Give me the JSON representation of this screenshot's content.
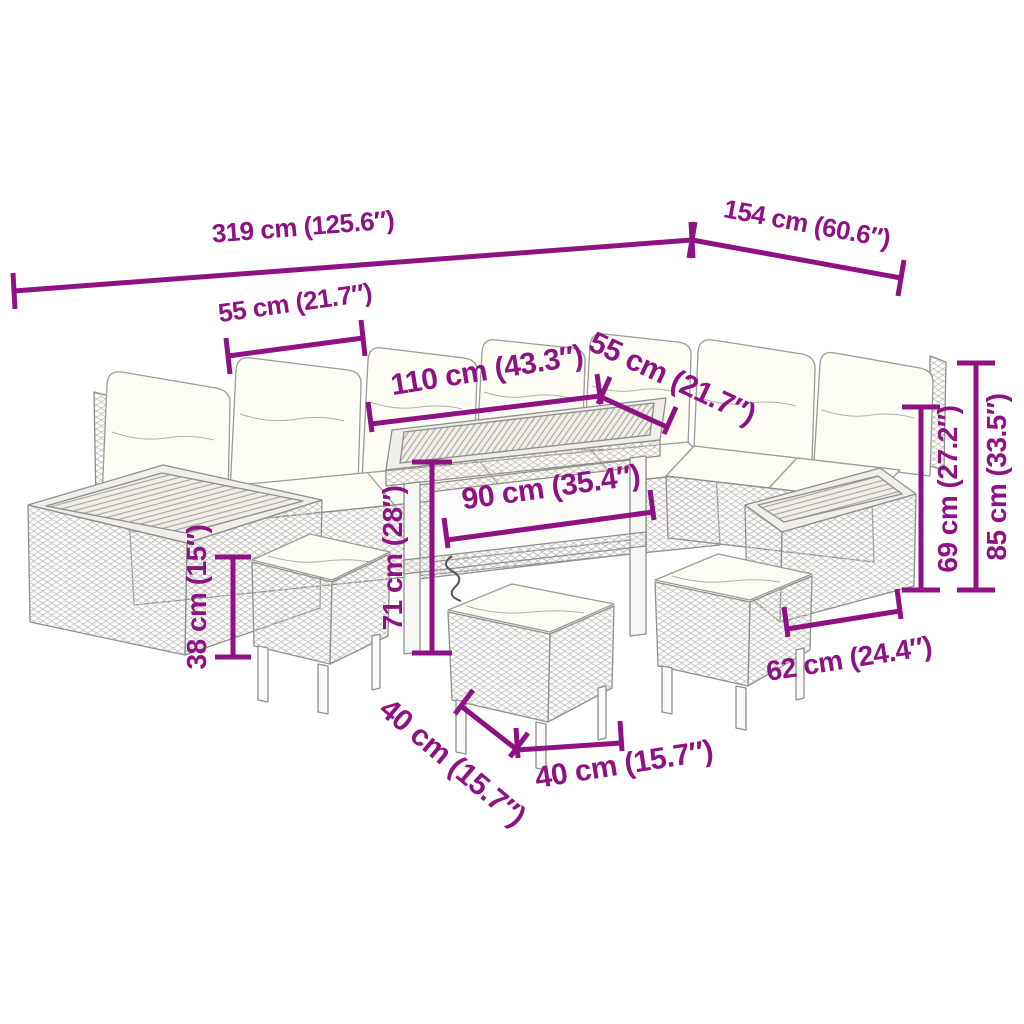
{
  "colors": {
    "accent": "#8E1283",
    "furniture_line": "#8f8f8f",
    "cushion_fill": "#fdfcf5"
  },
  "figure": {
    "type": "product-dimension-diagram",
    "subject": "poly rattan garden lounge set: corner sofa with cushions, wooden-top side tables, dining table and three stools"
  },
  "dims": {
    "overall_length": {
      "cm": "319",
      "inch": "125.6",
      "label": "319 cm (125.6″)"
    },
    "overall_depth": {
      "cm": "154",
      "inch": "60.6",
      "label": "154 cm (60.6″)"
    },
    "seat_width_left": {
      "cm": "55",
      "inch": "21.7",
      "label": "55 cm (21.7″)"
    },
    "sofa_section_length": {
      "cm": "110",
      "inch": "43.3",
      "label": "110 cm (43.3″)"
    },
    "seat_width_right": {
      "cm": "55",
      "inch": "21.7",
      "label": "55 cm (21.7″)"
    },
    "table_length": {
      "cm": "90",
      "inch": "35.4",
      "label": "90 cm (35.4″)"
    },
    "table_height": {
      "cm": "71",
      "inch": "28",
      "label": "71 cm (28″)"
    },
    "seat_height": {
      "cm": "38",
      "inch": "15",
      "label": "38 cm (15″)"
    },
    "backrest_height": {
      "cm": "69",
      "inch": "27.2",
      "label": "69 cm (27.2″)"
    },
    "total_height": {
      "cm": "85",
      "inch": "33.5",
      "label": "85 cm (33.5″)"
    },
    "side_table_length": {
      "cm": "62",
      "inch": "24.4",
      "label": "62 cm (24.4″)"
    },
    "stool_depth": {
      "cm": "40",
      "inch": "15.7",
      "label": "40 cm (15.7″)"
    },
    "stool_width": {
      "cm": "40",
      "inch": "15.7",
      "label": "40 cm (15.7″)"
    }
  }
}
